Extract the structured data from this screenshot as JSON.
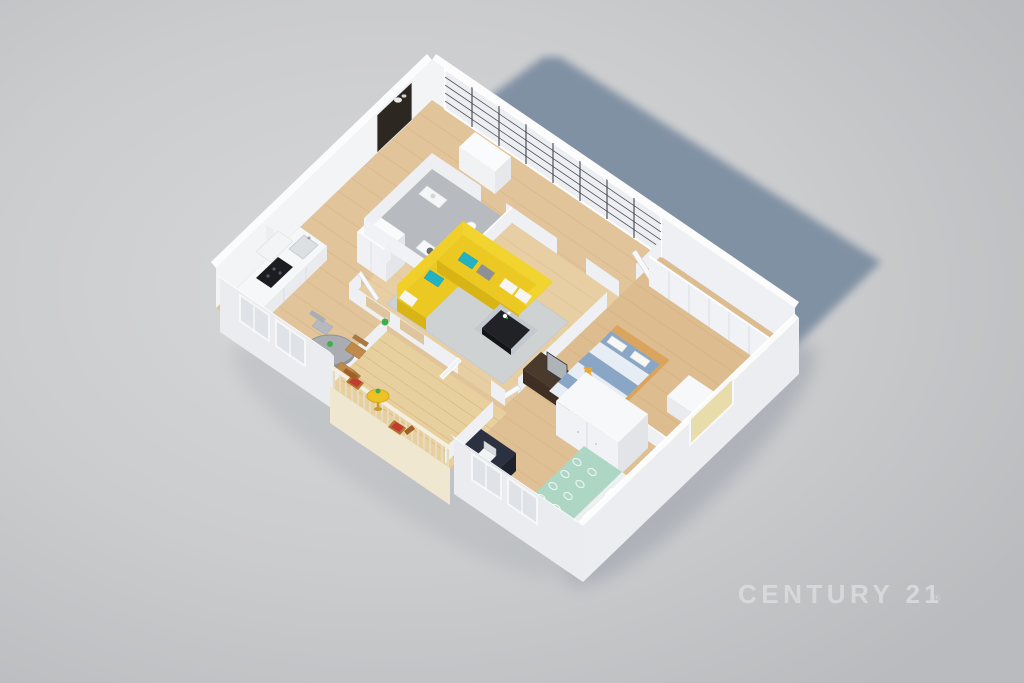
{
  "watermark": {
    "brand": "CENTURY 21",
    "registered": "®"
  },
  "scene": {
    "subject": "3D isometric floor-plan render of a two-bedroom apartment casting a blue shadow"
  },
  "colors": {
    "background_light": "#d7d8d9",
    "background_mid": "#cbccce",
    "background_edge": "#bcbec1",
    "cast_shadow": "#7b8da1",
    "floor_wood": "#e2c49a",
    "plank_line": "#cfa97a",
    "bathroom_floor": "#b7babe",
    "deck_wood": "#e8cf9e",
    "wall_white": "#f3f4f6",
    "wall_shaded": "#e9ebee",
    "wall_top": "#fcfcfd",
    "interior_wall": "#edeff2",
    "glazing": "#eceef1",
    "mullion": "#41454c",
    "entry_door": "#2d2722",
    "sofa_yellow": "#ecc822",
    "sofa_shadow": "#d8b414",
    "sofa_back": "#f2d42e",
    "pillow_teal": "#23b2c4",
    "pillow_gray": "#8d9197",
    "pillow_white": "#f6f5f1",
    "rug": "#ccd3da",
    "table_black": "#202226",
    "plinth": "#c3c9cf",
    "tv_console_brown": "#4a3a2c",
    "stripe_blue": "#8aa6c6",
    "stripe_light": "#e6edf4",
    "bed_wood": "#d9a55e",
    "teddy": "#e8a83c",
    "duvet_green": "#aed6c5",
    "duvet_pattern": "#e9f4ef",
    "sheet": "#eef1f2",
    "desk_navy": "#2b3140",
    "wardrobe": "#f1f2f5",
    "dining_table": "#a9adb2",
    "chair_gray": "#b6bac0",
    "chair_wood": "#c08a4a",
    "balcony_table": "#eec223",
    "balcony_chair_wood": "#b4722f",
    "chair_red": "#c23b33",
    "window_cream": "#e8dcab",
    "window_glass": "#dfe3e7",
    "plant": "#3fae4a",
    "watermark": "#dcdddf"
  }
}
